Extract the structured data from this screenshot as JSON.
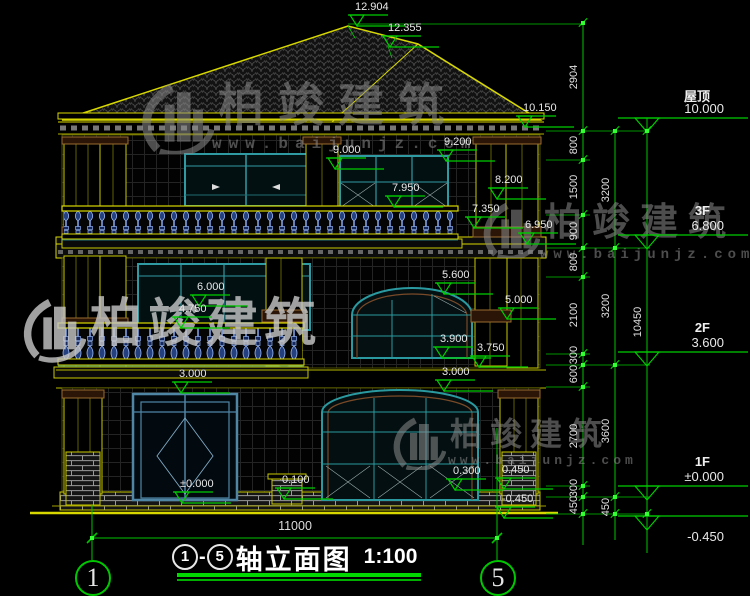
{
  "watermark": {
    "name": "柏竣建筑",
    "url": "www.baijunjz.com"
  },
  "title_bar": {
    "axis_start": "1",
    "separator": "-",
    "axis_end": "5",
    "title": "轴立面图",
    "scale": "1:100"
  },
  "axis_bubbles": {
    "left": "1",
    "right": "5"
  },
  "bottom_dim": {
    "value": "11000"
  },
  "elevation_markers": [
    {
      "label": "12.904",
      "x": 348,
      "y": 15
    },
    {
      "label": "12.355",
      "x": 381,
      "y": 36
    },
    {
      "label": "10.150",
      "x": 516,
      "y": 116
    },
    {
      "label": "9.200",
      "x": 437,
      "y": 150
    },
    {
      "label": "9.000",
      "x": 326,
      "y": 158
    },
    {
      "label": "8.200",
      "x": 488,
      "y": 188
    },
    {
      "label": "7.950",
      "x": 385,
      "y": 196
    },
    {
      "label": "7.350",
      "x": 465,
      "y": 217
    },
    {
      "label": "6.950",
      "x": 518,
      "y": 233
    },
    {
      "label": "6.000",
      "x": 190,
      "y": 295
    },
    {
      "label": "5.600",
      "x": 435,
      "y": 283
    },
    {
      "label": "5.000",
      "x": 498,
      "y": 308
    },
    {
      "label": "4.750",
      "x": 172,
      "y": 317
    },
    {
      "label": "3.900",
      "x": 433,
      "y": 347
    },
    {
      "label": "3.750",
      "x": 470,
      "y": 356
    },
    {
      "label": "3.000",
      "x": 435,
      "y": 380
    },
    {
      "label": "3.000",
      "x": 172,
      "y": 382
    },
    {
      "label": "0.450",
      "x": 495,
      "y": 478
    },
    {
      "label": "0.300",
      "x": 446,
      "y": 479
    },
    {
      "label": "0.100",
      "x": 275,
      "y": 488
    },
    {
      "label": "±0.000",
      "x": 173,
      "y": 492
    },
    {
      "label": "-0.450",
      "x": 495,
      "y": 507
    }
  ],
  "floor_markers": [
    {
      "name": "屋顶",
      "elev": "10.000",
      "y": 118,
      "below": false
    },
    {
      "name": "3F",
      "elev": "6.800",
      "y": 235,
      "below": false
    },
    {
      "name": "2F",
      "elev": "3.600",
      "y": 352,
      "below": false
    },
    {
      "name": "1F",
      "elev": "±0.000",
      "y": 486,
      "below": false
    },
    {
      "name": "",
      "elev": "-0.450",
      "y": 516,
      "below": true
    }
  ],
  "dim_columns": [
    {
      "x": 583,
      "ticks": [
        23,
        131,
        160,
        215,
        248,
        277,
        354,
        365,
        387,
        486,
        497,
        514
      ],
      "segments": [
        {
          "v": "2904",
          "y": 77
        },
        {
          "v": "800",
          "y": 145
        },
        {
          "v": "1500",
          "y": 187
        },
        {
          "v": "900",
          "y": 231
        },
        {
          "v": "800",
          "y": 262
        },
        {
          "v": "2100",
          "y": 315
        },
        {
          "v": "300",
          "y": 355
        },
        {
          "v": "600",
          "y": 374
        },
        {
          "v": "2700",
          "y": 436
        },
        {
          "v": "300",
          "y": 488
        },
        {
          "v": "450",
          "y": 505
        }
      ]
    },
    {
      "x": 615,
      "ticks": [
        131,
        248,
        365,
        497,
        514
      ],
      "segments": [
        {
          "v": "3200",
          "y": 190
        },
        {
          "v": "3200",
          "y": 306
        },
        {
          "v": "3600",
          "y": 431
        },
        {
          "v": "450",
          "y": 507
        }
      ]
    },
    {
      "x": 647,
      "ticks": [
        131,
        514
      ],
      "segments": [
        {
          "v": "10450",
          "y": 322
        }
      ]
    }
  ]
}
